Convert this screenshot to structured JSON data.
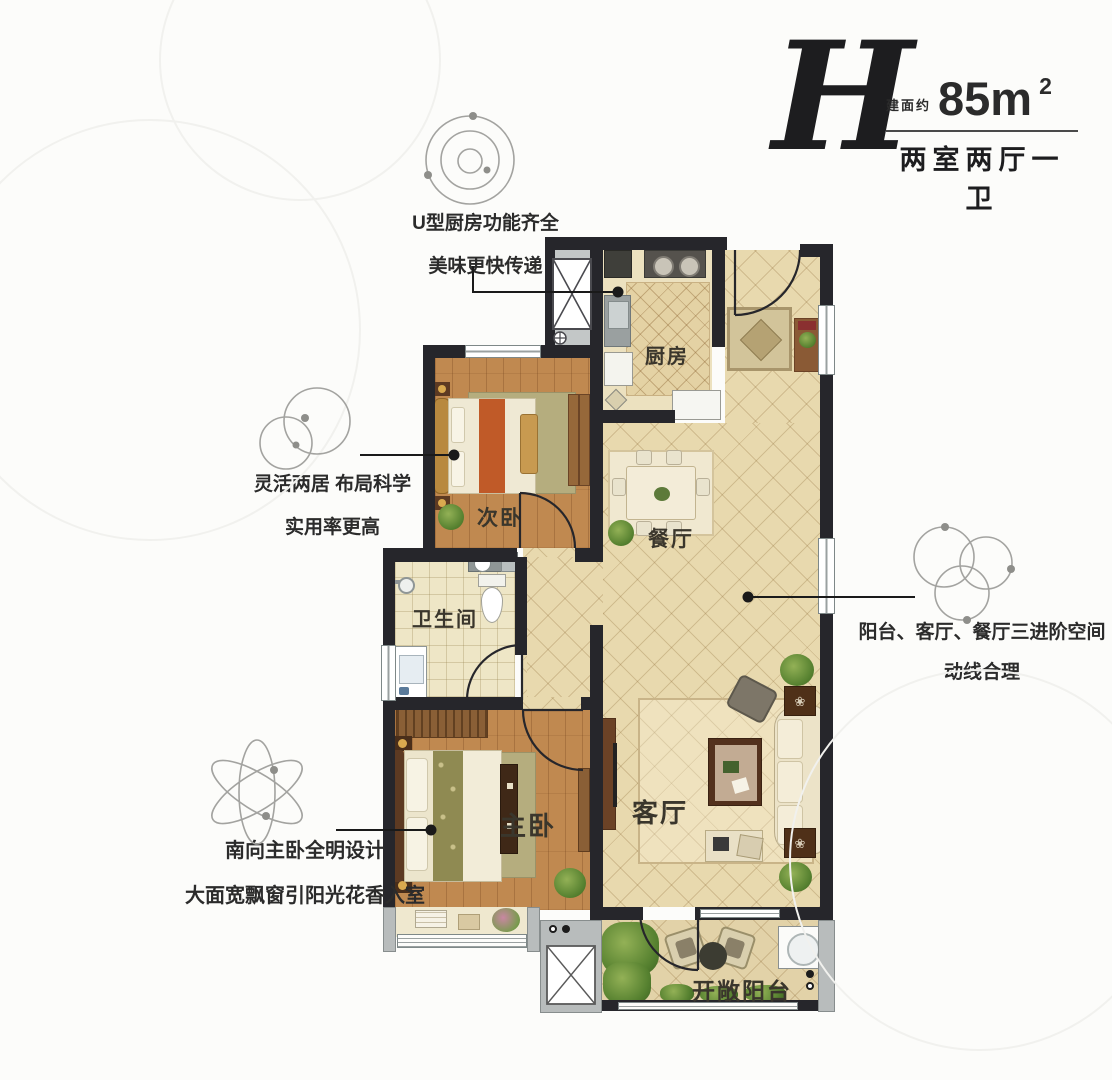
{
  "header": {
    "plan_letter": "H",
    "area_label": "建面约",
    "area_value": "85m",
    "area_sup": "2",
    "layout_type": "两室两厅一卫"
  },
  "annotations": {
    "kitchen": {
      "line1": "U型厨房功能齐全",
      "line2": "美味更快传递"
    },
    "layout": {
      "line1": "灵活两居 布局科学",
      "line2": "实用率更高"
    },
    "master": {
      "line1": "南向主卧全明设计",
      "line2": "大面宽飘窗引阳光花香入室"
    },
    "flow": {
      "line1": "阳台、客厅、餐厅三进阶空间",
      "line2": "动线合理"
    }
  },
  "rooms": {
    "kitchen": "厨房",
    "second_bedroom": "次卧",
    "dining": "餐厅",
    "bathroom": "卫生间",
    "master_bedroom": "主卧",
    "living": "客厅",
    "balcony": "开敞阳台"
  },
  "icons": {
    "kitchen_annotation": "orbit-circles",
    "layout_annotation": "double-circles",
    "master_annotation": "atom-ellipses",
    "flow_annotation": "triple-circles",
    "side_table_flower": "❀"
  },
  "colors": {
    "wall": "#26262b",
    "wood_floor": "#c08950",
    "tile_floor": "#e8d9ae",
    "accent_runner": "#c05a28",
    "plant_green": "#6f9a43",
    "ink": "#2b2b2b"
  }
}
